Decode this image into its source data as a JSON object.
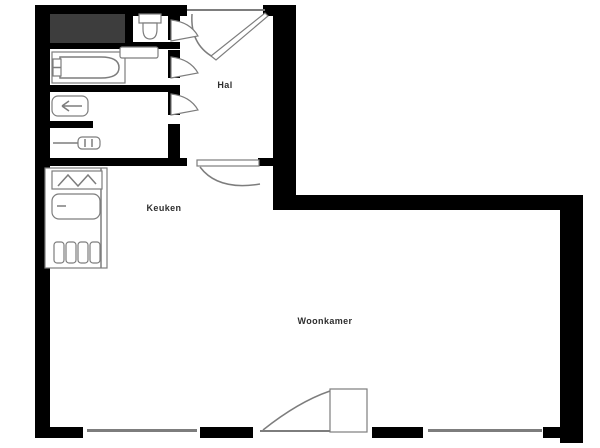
{
  "rooms": {
    "hal": {
      "label": "Hal"
    },
    "keuken": {
      "label": "Keuken"
    },
    "woonkamer": {
      "label": "Woonkamer"
    }
  },
  "fixtures": {
    "closet": "dark filled storage block",
    "toilet": "cistern + bowl symbol",
    "bathtub": "outline with rounded inner tub and taps",
    "bathroom-sink": "small vanity rectangle",
    "laundry-basin": "rounded basin with left arrow",
    "towel-radiator": "bar with sectioned box",
    "privacy-wall": "short solid wall stub",
    "kitchen-counter": "outlined counter run",
    "kitchen-sink": "hatched sink top",
    "kitchen-basin": "rounded basin",
    "stove": "four burner bars",
    "front-door": "quarter-swing arc, top of hall",
    "interior-door": "fan swing symbol x3 into hall",
    "hall-kitchen-door": "leaf with shallow swing",
    "balcony-door": "leaf with swing arc, bottom wall",
    "window": "thin double-gap line in bottom wall"
  },
  "colors": {
    "wall": "#000000",
    "line": "#7d7d7d",
    "closet": "#3d3d3d",
    "bg": "#ffffff",
    "text": "#2e2e2e"
  }
}
